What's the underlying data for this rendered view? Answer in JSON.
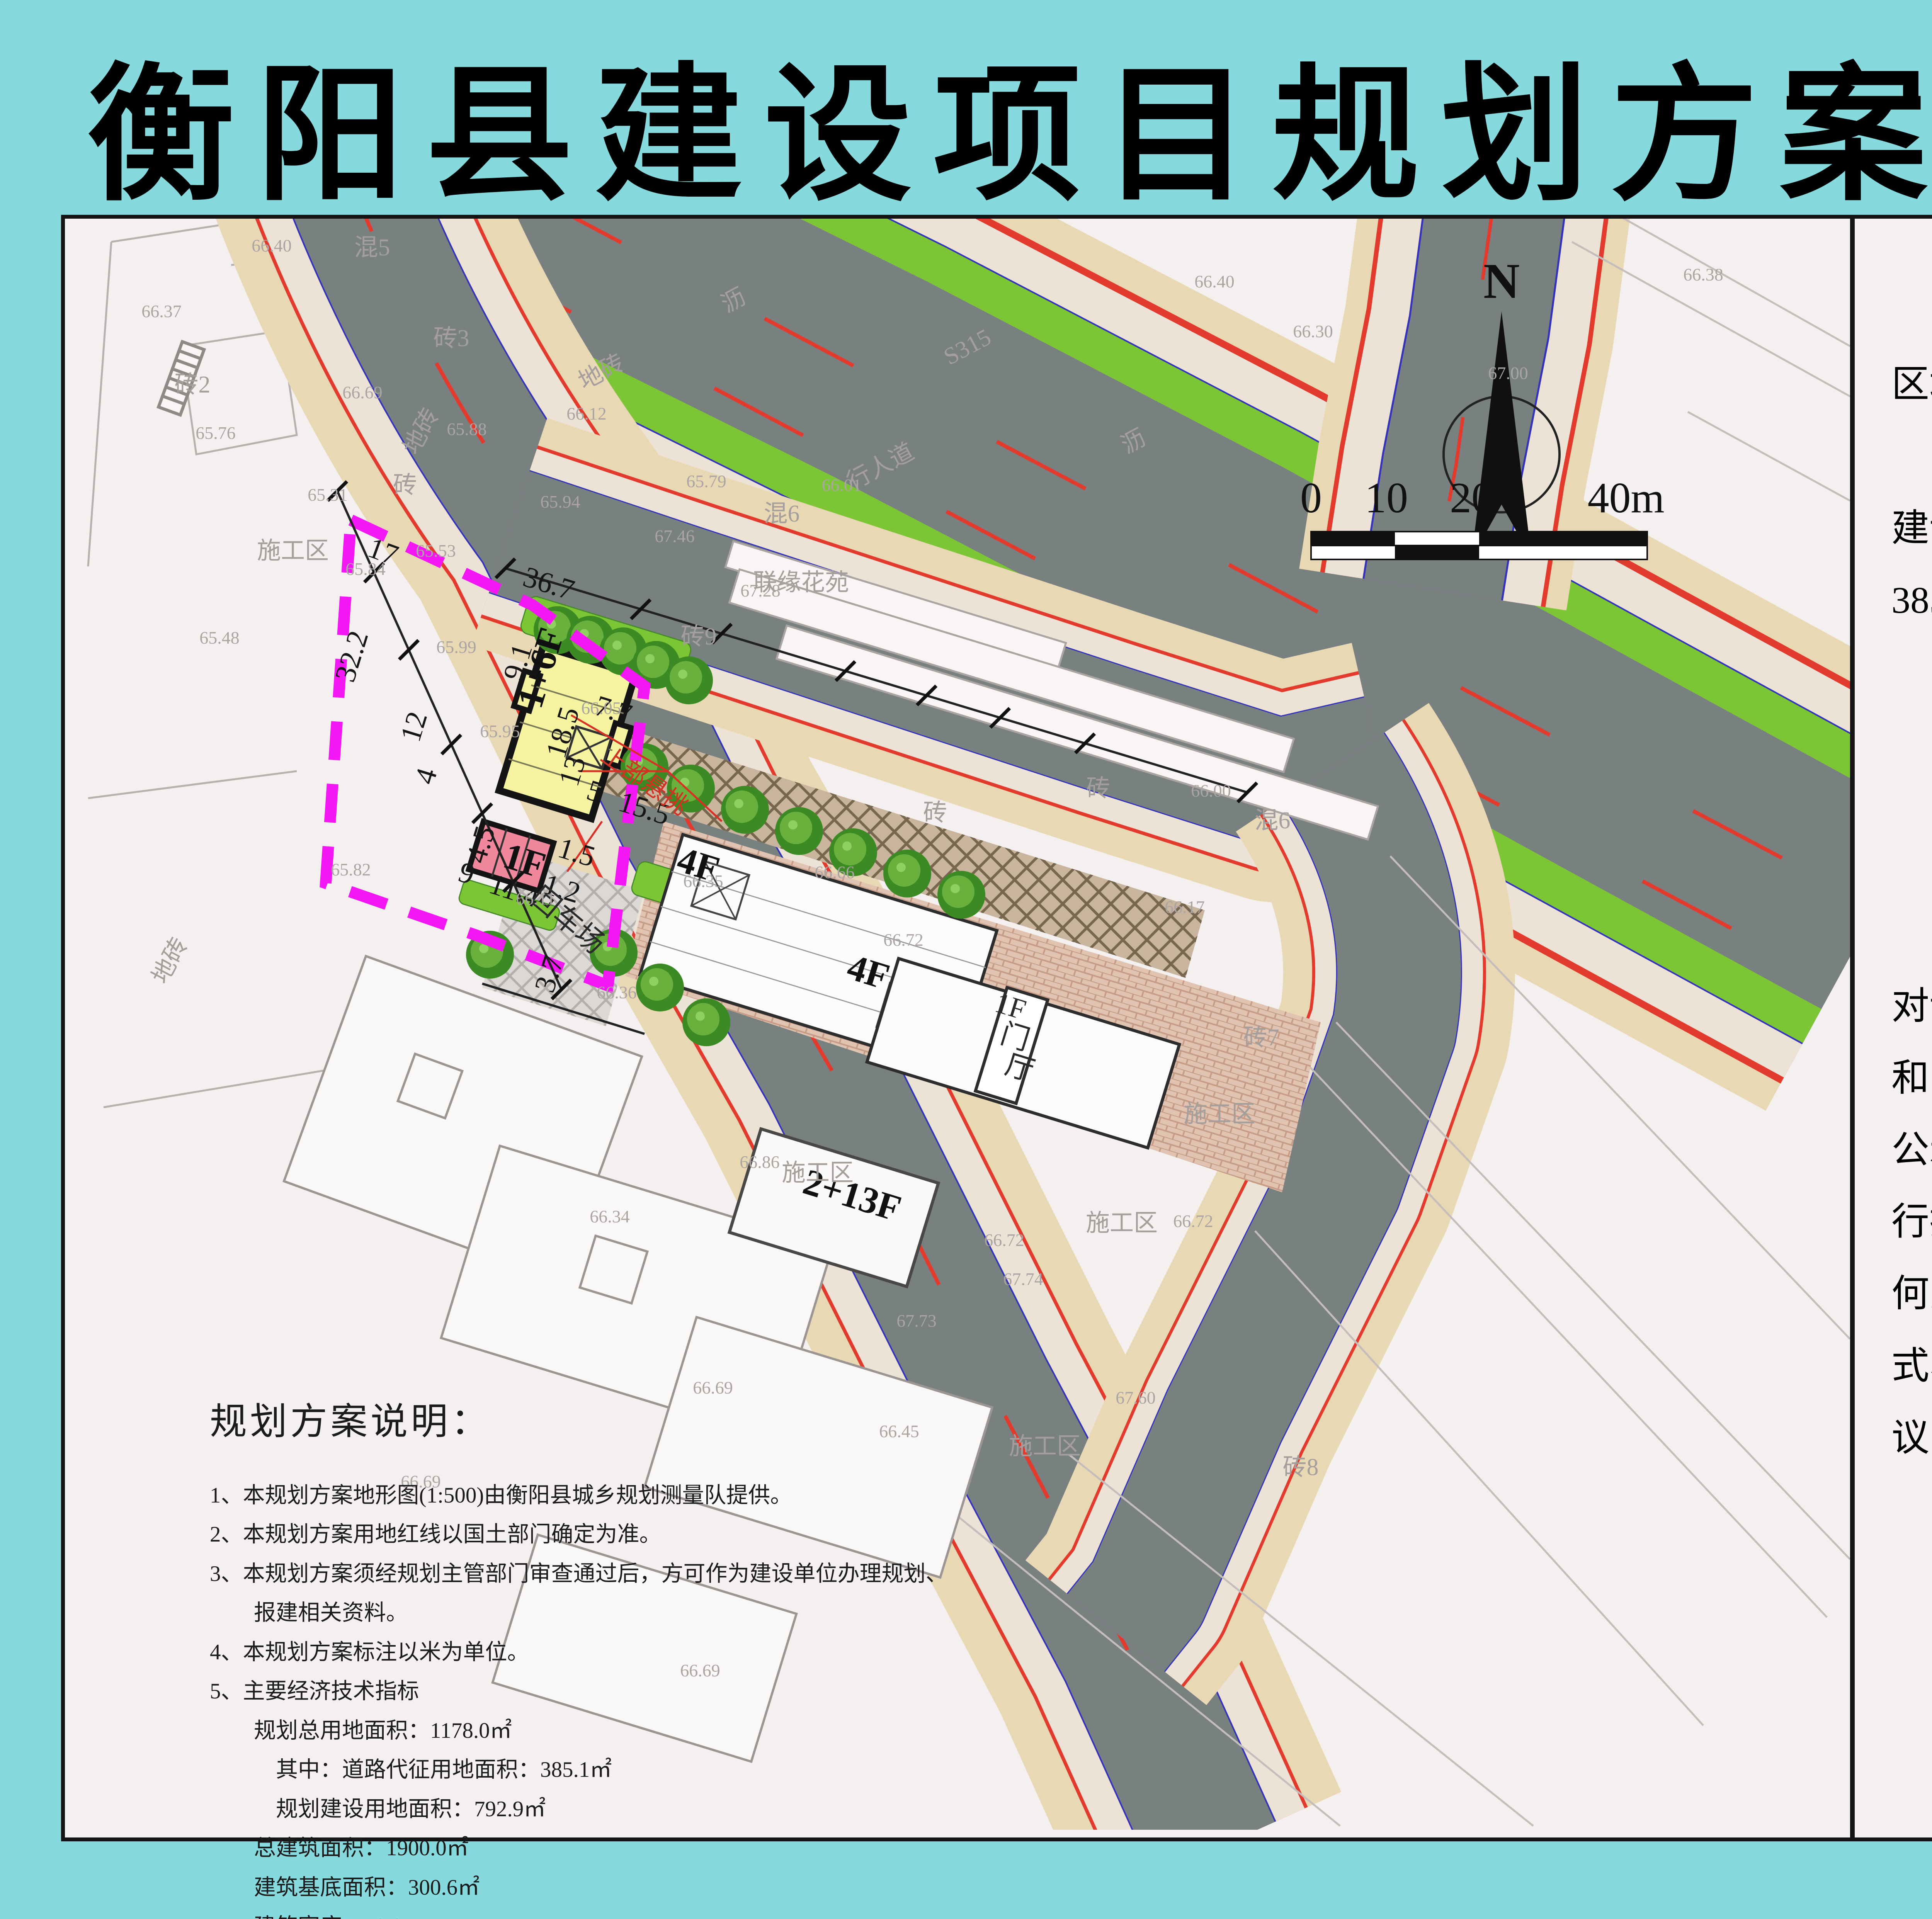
{
  "title": "衡阳县建设项目规划方案批前公示",
  "footer": {
    "publisher": "衡阳县自然资源局监制"
  },
  "right_panel": {
    "para1": "“财福苑”项目位于衡阳县西渡镇米子社区培元组，主要技术经济指标如下：",
    "indicators": [
      "1、规划总用地面积：1178.0㎡（其中，建设用地面积792.9㎡、城市公共用地面积385.1㎡）",
      "2、规划总建筑面积：1900.0㎡",
      "3、容积率：2.4",
      "4、建筑密度：38.0%"
    ],
    "para2": "2020年1月6日，我局召开局党组会议，对该项目方案审议并通过，根据中华人民共和国住房和城乡建设部《关于城乡规划公开公示的规定》相关规定，我局现对该方案进行批前公示，有关单位及个人对该方案有任何意见及建议，可在公示期间通过书面形式、网上留言或致电向我局反映，如无异议，我局将按程序对该方案进行审批。",
    "website": "网址：http://www.hyx.gov.com",
    "contact": "联系人：周小成",
    "phone": "联系电话：0734-6653022",
    "period": "公示时间：2020年7月8日—2020年7月16日"
  },
  "notes": {
    "title": "规划方案说明：",
    "lines": [
      "1、本规划方案地形图(1:500)由衡阳县城乡规划测量队提供。",
      "2、本规划方案用地红线以国土部门确定为准。",
      "3、本规划方案须经规划主管部门审查通过后，方可作为建设单位办理规划、",
      "　　报建相关资料。",
      "4、本规划方案标注以米为单位。",
      "5、主要经济技术指标",
      "　　规划总用地面积：1178.0㎡",
      "　　　其中：道路代征用地面积：385.1㎡",
      "　　　规划建设用地面积：792.9㎡",
      "　　总建筑面积：1900.0㎡",
      "　　建筑基底面积：300.6㎡",
      "　　建筑密度：38.0%",
      "　　容积率：2.4"
    ]
  },
  "map": {
    "labels": [
      [
        "混5",
        795,
        95,
        0,
        "g"
      ],
      [
        "66.40",
        535,
        85,
        0,
        "e"
      ],
      [
        "66.37",
        250,
        255,
        0,
        "e"
      ],
      [
        "砖2",
        330,
        450,
        0,
        "g"
      ],
      [
        "砖3",
        1000,
        330,
        0,
        "g"
      ],
      [
        "66.69",
        770,
        465,
        0,
        "e"
      ],
      [
        "砖",
        880,
        710,
        0,
        "g"
      ],
      [
        "65.76",
        390,
        570,
        0,
        "e"
      ],
      [
        "65.31",
        680,
        730,
        0,
        "e"
      ],
      [
        "65.48",
        400,
        1100,
        0,
        "e"
      ],
      [
        "65.82",
        740,
        1700,
        0,
        "e"
      ],
      [
        "地砖",
        940,
        560,
        -62,
        "g"
      ],
      [
        "地砖",
        290,
        1930,
        -62,
        "g"
      ],
      [
        "施工区",
        590,
        880,
        0,
        "g"
      ],
      [
        "沥",
        1740,
        230,
        -28,
        "g"
      ],
      [
        "沥",
        2775,
        595,
        -28,
        "g"
      ],
      [
        "S315",
        2345,
        350,
        -28,
        "g"
      ],
      [
        "行人道",
        2120,
        660,
        -28,
        "g"
      ],
      [
        "地砖",
        1398,
        415,
        -28,
        "g"
      ],
      [
        "65.88",
        1040,
        560,
        0,
        "e"
      ],
      [
        "65.53",
        960,
        875,
        0,
        "e"
      ],
      [
        "66.12",
        1350,
        520,
        0,
        "e"
      ],
      [
        "65.94",
        1282,
        748,
        0,
        "e"
      ],
      [
        "65.79",
        1660,
        695,
        0,
        "e"
      ],
      [
        "66.01",
        2010,
        705,
        0,
        "e"
      ],
      [
        "66.30",
        3230,
        307,
        0,
        "e"
      ],
      [
        "67.00",
        3735,
        415,
        0,
        "e"
      ],
      [
        "66.38",
        4240,
        160,
        0,
        "e"
      ],
      [
        "66.40",
        2975,
        178,
        0,
        "e"
      ],
      [
        "67.46",
        1578,
        837,
        0,
        "e"
      ],
      [
        "67.28",
        1800,
        978,
        0,
        "e"
      ],
      [
        "17",
        815,
        885,
        20,
        "d"
      ],
      [
        "32.2",
        766,
        1140,
        -73,
        "d"
      ],
      [
        "12",
        927,
        1322,
        -73,
        "d"
      ],
      [
        "4",
        958,
        1450,
        -73,
        "d"
      ],
      [
        "9",
        1032,
        1718,
        18,
        "d"
      ],
      [
        "11.4",
        1155,
        1763,
        18,
        "d"
      ],
      [
        "3.7",
        1277,
        1962,
        -73,
        "d"
      ],
      [
        "36.7",
        1245,
        968,
        17,
        "d"
      ],
      [
        "9.1",
        1196,
        1155,
        -73,
        "d"
      ],
      [
        "7.7",
        1412,
        1296,
        17,
        "d"
      ],
      [
        "5",
        1364,
        1506,
        17,
        "d"
      ],
      [
        "15.5",
        1492,
        1550,
        17,
        "d"
      ],
      [
        "1.5",
        1317,
        1664,
        17,
        "d"
      ],
      [
        "1.2",
        1279,
        1758,
        17,
        "d"
      ],
      [
        "4.5",
        1100,
        1627,
        -73,
        "d"
      ],
      [
        "18.5",
        1312,
        1337,
        -73,
        "d"
      ],
      [
        "13",
        1337,
        1437,
        -73,
        "d"
      ],
      [
        "1+6F",
        1262,
        1172,
        -73,
        "b"
      ],
      [
        "1F",
        1180,
        1692,
        17,
        "b"
      ],
      [
        "回车场",
        1285,
        1835,
        40,
        "k"
      ],
      [
        "上部悬挑",
        1488,
        1472,
        35,
        "r"
      ],
      [
        "66.05",
        1388,
        1282,
        0,
        "e"
      ],
      [
        "65.84",
        778,
        922,
        0,
        "e"
      ],
      [
        "65.99",
        1013,
        1124,
        0,
        "e"
      ],
      [
        "65.95",
        1126,
        1342,
        0,
        "e"
      ],
      [
        "66.11",
        1218,
        1775,
        0,
        "e"
      ],
      [
        "66.35",
        1652,
        1730,
        0,
        "e"
      ],
      [
        "联缘花苑",
        1905,
        962,
        0,
        "g"
      ],
      [
        "砖9",
        1640,
        1102,
        0,
        "g"
      ],
      [
        "混6",
        1855,
        784,
        0,
        "g"
      ],
      [
        "砖",
        2252,
        1558,
        0,
        "g"
      ],
      [
        "砖",
        2674,
        1495,
        0,
        "g"
      ],
      [
        "混6",
        3125,
        1578,
        0,
        "g"
      ],
      [
        "砖7",
        3096,
        2140,
        0,
        "g"
      ],
      [
        "66.00",
        2966,
        1496,
        0,
        "e"
      ],
      [
        "66.17",
        2898,
        1797,
        0,
        "e"
      ],
      [
        "4F",
        1630,
        1702,
        17,
        "b"
      ],
      [
        "4F",
        2070,
        1980,
        17,
        "b"
      ],
      [
        "1F",
        2440,
        2062,
        17,
        "k"
      ],
      [
        "门",
        2452,
        2142,
        17,
        "k"
      ],
      [
        "厅",
        2464,
        2222,
        17,
        "k"
      ],
      [
        "66.66",
        1992,
        1707,
        0,
        "e"
      ],
      [
        "66.72",
        2170,
        1882,
        0,
        "e"
      ],
      [
        "66.36",
        1428,
        2018,
        0,
        "e"
      ],
      [
        "2+13F",
        2028,
        2558,
        17,
        "b"
      ],
      [
        "施工区",
        1948,
        2490,
        0,
        "g"
      ],
      [
        "66.86",
        1798,
        2457,
        0,
        "e"
      ],
      [
        "66.34",
        1410,
        2598,
        0,
        "e"
      ],
      [
        "66.69",
        921,
        3284,
        0,
        "e"
      ],
      [
        "66.69",
        1677,
        3041,
        0,
        "e"
      ],
      [
        "66.69",
        1644,
        3773,
        0,
        "e"
      ],
      [
        "施工区",
        2735,
        2620,
        0,
        "g"
      ],
      [
        "施工区",
        2536,
        3198,
        0,
        "g"
      ],
      [
        "施工区",
        2988,
        2338,
        0,
        "g"
      ],
      [
        "砖8",
        3198,
        3252,
        0,
        "g"
      ],
      [
        "66.72",
        2920,
        2610,
        0,
        "e"
      ],
      [
        "66.72",
        2431,
        2659,
        0,
        "e"
      ],
      [
        "67.60",
        2771,
        3067,
        0,
        "e"
      ],
      [
        "67.73",
        2204,
        2868,
        0,
        "e"
      ],
      [
        "66.45",
        2159,
        3154,
        0,
        "e"
      ],
      [
        "67.74",
        2480,
        2760,
        0,
        "e"
      ],
      [
        "N",
        3718,
        205,
        0,
        "n"
      ],
      [
        "0",
        3225,
        760,
        0,
        "s"
      ],
      [
        "10",
        3420,
        760,
        0,
        "s"
      ],
      [
        "20",
        3640,
        760,
        0,
        "s"
      ],
      [
        "40m",
        4040,
        760,
        0,
        "s"
      ]
    ]
  }
}
